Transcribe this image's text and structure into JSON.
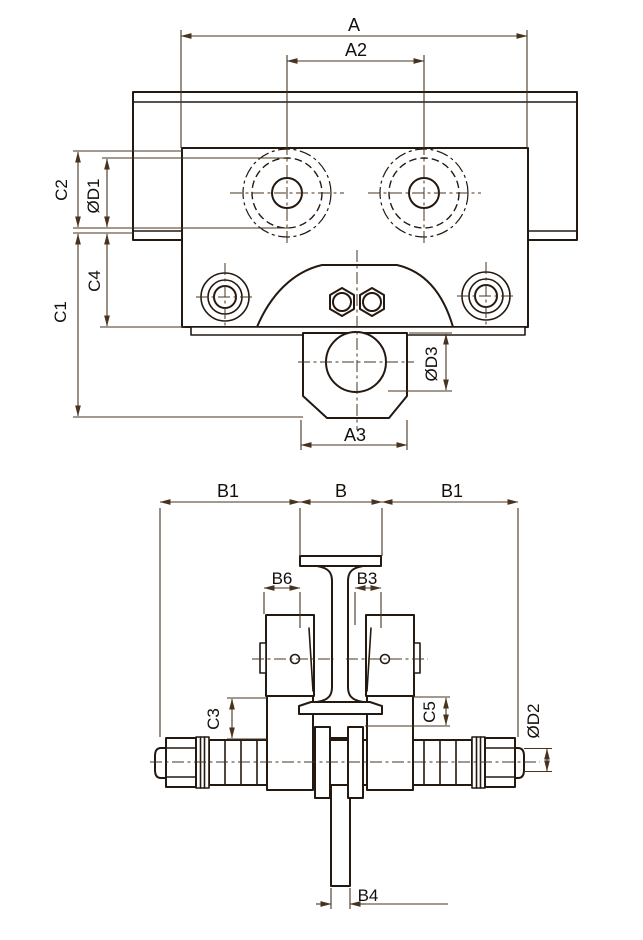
{
  "drawing": {
    "kind": "technical-dimension-drawing",
    "line_color": "#241911",
    "dimension_color": "#47331f",
    "background": "#ffffff"
  },
  "front_view": {
    "labels": {
      "a": "A",
      "a2": "A2",
      "c2": "C2",
      "d1": "ØD1",
      "c4": "C4",
      "c1": "C1",
      "d3": "ØD3",
      "a3": "A3"
    }
  },
  "side_view": {
    "labels": {
      "b1_left": "B1",
      "b": "B",
      "b1_right": "B1",
      "b6": "B6",
      "b3": "B3",
      "c3": "C3",
      "c5": "C5",
      "d2": "ØD2",
      "b4": "B4"
    }
  }
}
